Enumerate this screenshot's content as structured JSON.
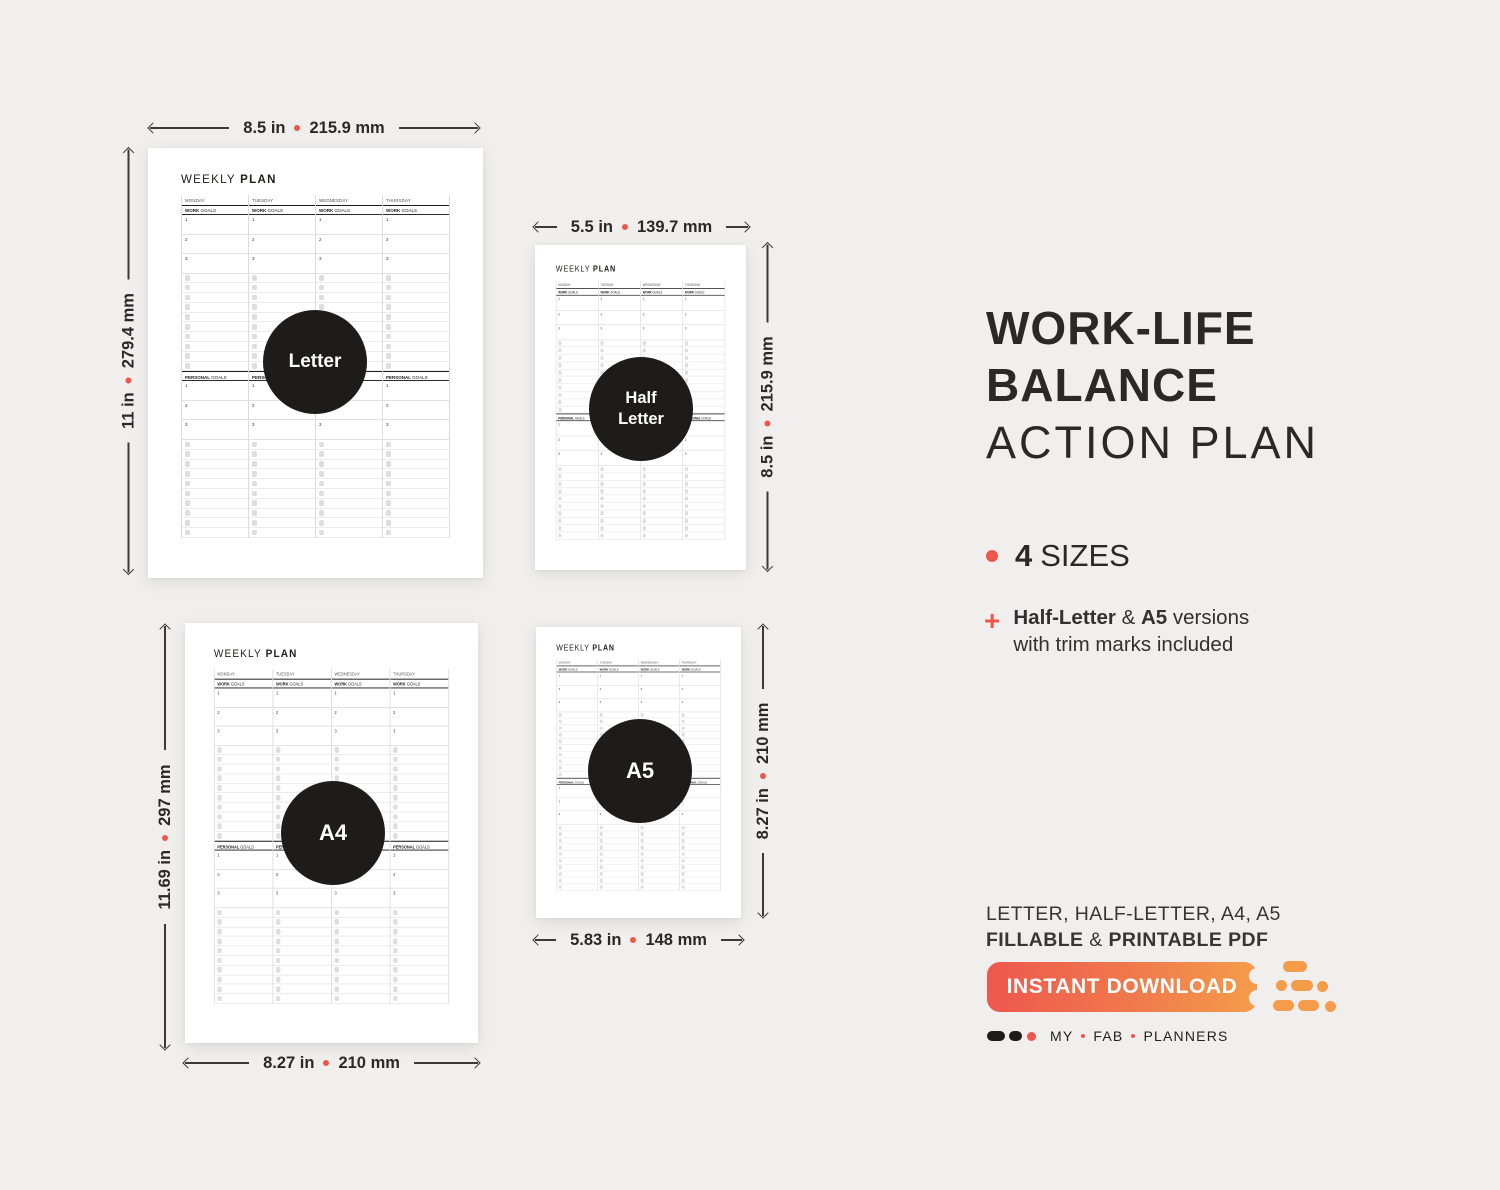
{
  "colors": {
    "background": "#f0efee",
    "page": "#ffffff",
    "ink": "#2a2926",
    "accent_red": "#ee574e",
    "accent_orange": "#f49c4a",
    "circle_black": "#1d1c1a",
    "line_dark": "#3b3a38"
  },
  "planner_template": {
    "title_word1": "WEEKLY",
    "title_word2": "PLAN",
    "days": [
      "MONDAY",
      "TUESDAY",
      "WEDNESDAY",
      "THURSDAY"
    ],
    "sections": [
      {
        "label_bold": "WORK",
        "label_rest": "GOALS",
        "numbered": [
          "1",
          "2",
          "3"
        ],
        "checklist_count": 10
      },
      {
        "label_bold": "PERSONAL",
        "label_rest": "GOALS",
        "numbered": [
          "1",
          "2",
          "3"
        ],
        "checklist_count": 10
      }
    ]
  },
  "pages": [
    {
      "id": "letter",
      "circle_label": [
        "Letter"
      ]
    },
    {
      "id": "half-letter",
      "circle_label": [
        "Half",
        "Letter"
      ]
    },
    {
      "id": "a4",
      "circle_label": [
        "A4"
      ]
    },
    {
      "id": "a5",
      "circle_label": [
        "A5"
      ]
    }
  ],
  "dimensions": {
    "letter_width": {
      "inches": "8.5 in",
      "mm": "215.9 mm"
    },
    "letter_height": {
      "inches": "11 in",
      "mm": "279.4 mm"
    },
    "half_letter_width": {
      "inches": "5.5 in",
      "mm": "139.7 mm"
    },
    "half_letter_height": {
      "inches": "8.5 in",
      "mm": "215.9 mm"
    },
    "a4_width": {
      "inches": "8.27 in",
      "mm": "210 mm"
    },
    "a4_height": {
      "inches": "11.69 in",
      "mm": "297 mm"
    },
    "a5_width": {
      "inches": "5.83 in",
      "mm": "148 mm"
    },
    "a5_height": {
      "inches": "8.27 in",
      "mm": "210 mm"
    }
  },
  "panel": {
    "title_line1": "WORK-LIFE",
    "title_line2": "BALANCE",
    "title_line3": "ACTION PLAN",
    "sizes": {
      "count": "4",
      "label": "SIZES"
    },
    "feature": {
      "marker": "+",
      "bold1": "Half-Letter",
      "sep": "&",
      "bold2": "A5",
      "rest": "versions",
      "line2": "with trim marks included"
    },
    "formats_line": "LETTER, HALF-LETTER, A4, A5",
    "file_line": {
      "bold1": "FILLABLE",
      "sep": "&",
      "bold2": "PRINTABLE PDF"
    },
    "button_label": "INSTANT DOWNLOAD",
    "brand": {
      "words": [
        "MY",
        "FAB",
        "PLANNERS"
      ]
    }
  }
}
